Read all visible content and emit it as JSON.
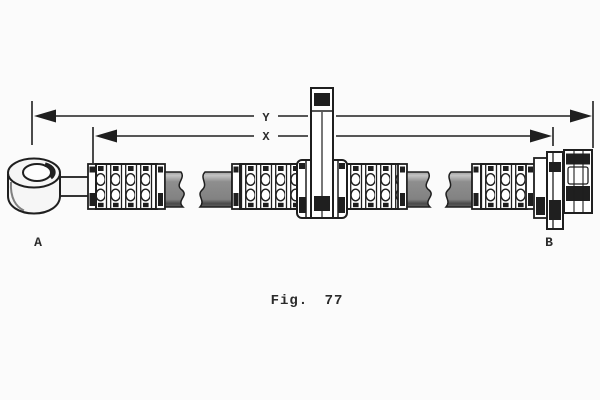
{
  "figure": {
    "caption": "Fig. 77"
  },
  "diagram": {
    "dimensions": {
      "outer_label": "Y",
      "inner_label": "X"
    },
    "ends": {
      "left_label": "A",
      "right_label": "B"
    }
  },
  "colors": {
    "background": "#fbfbfb",
    "ink": "#1f1f1f",
    "hose_gray": "#8c8c8c",
    "metal_white": "#f7f7f7"
  }
}
